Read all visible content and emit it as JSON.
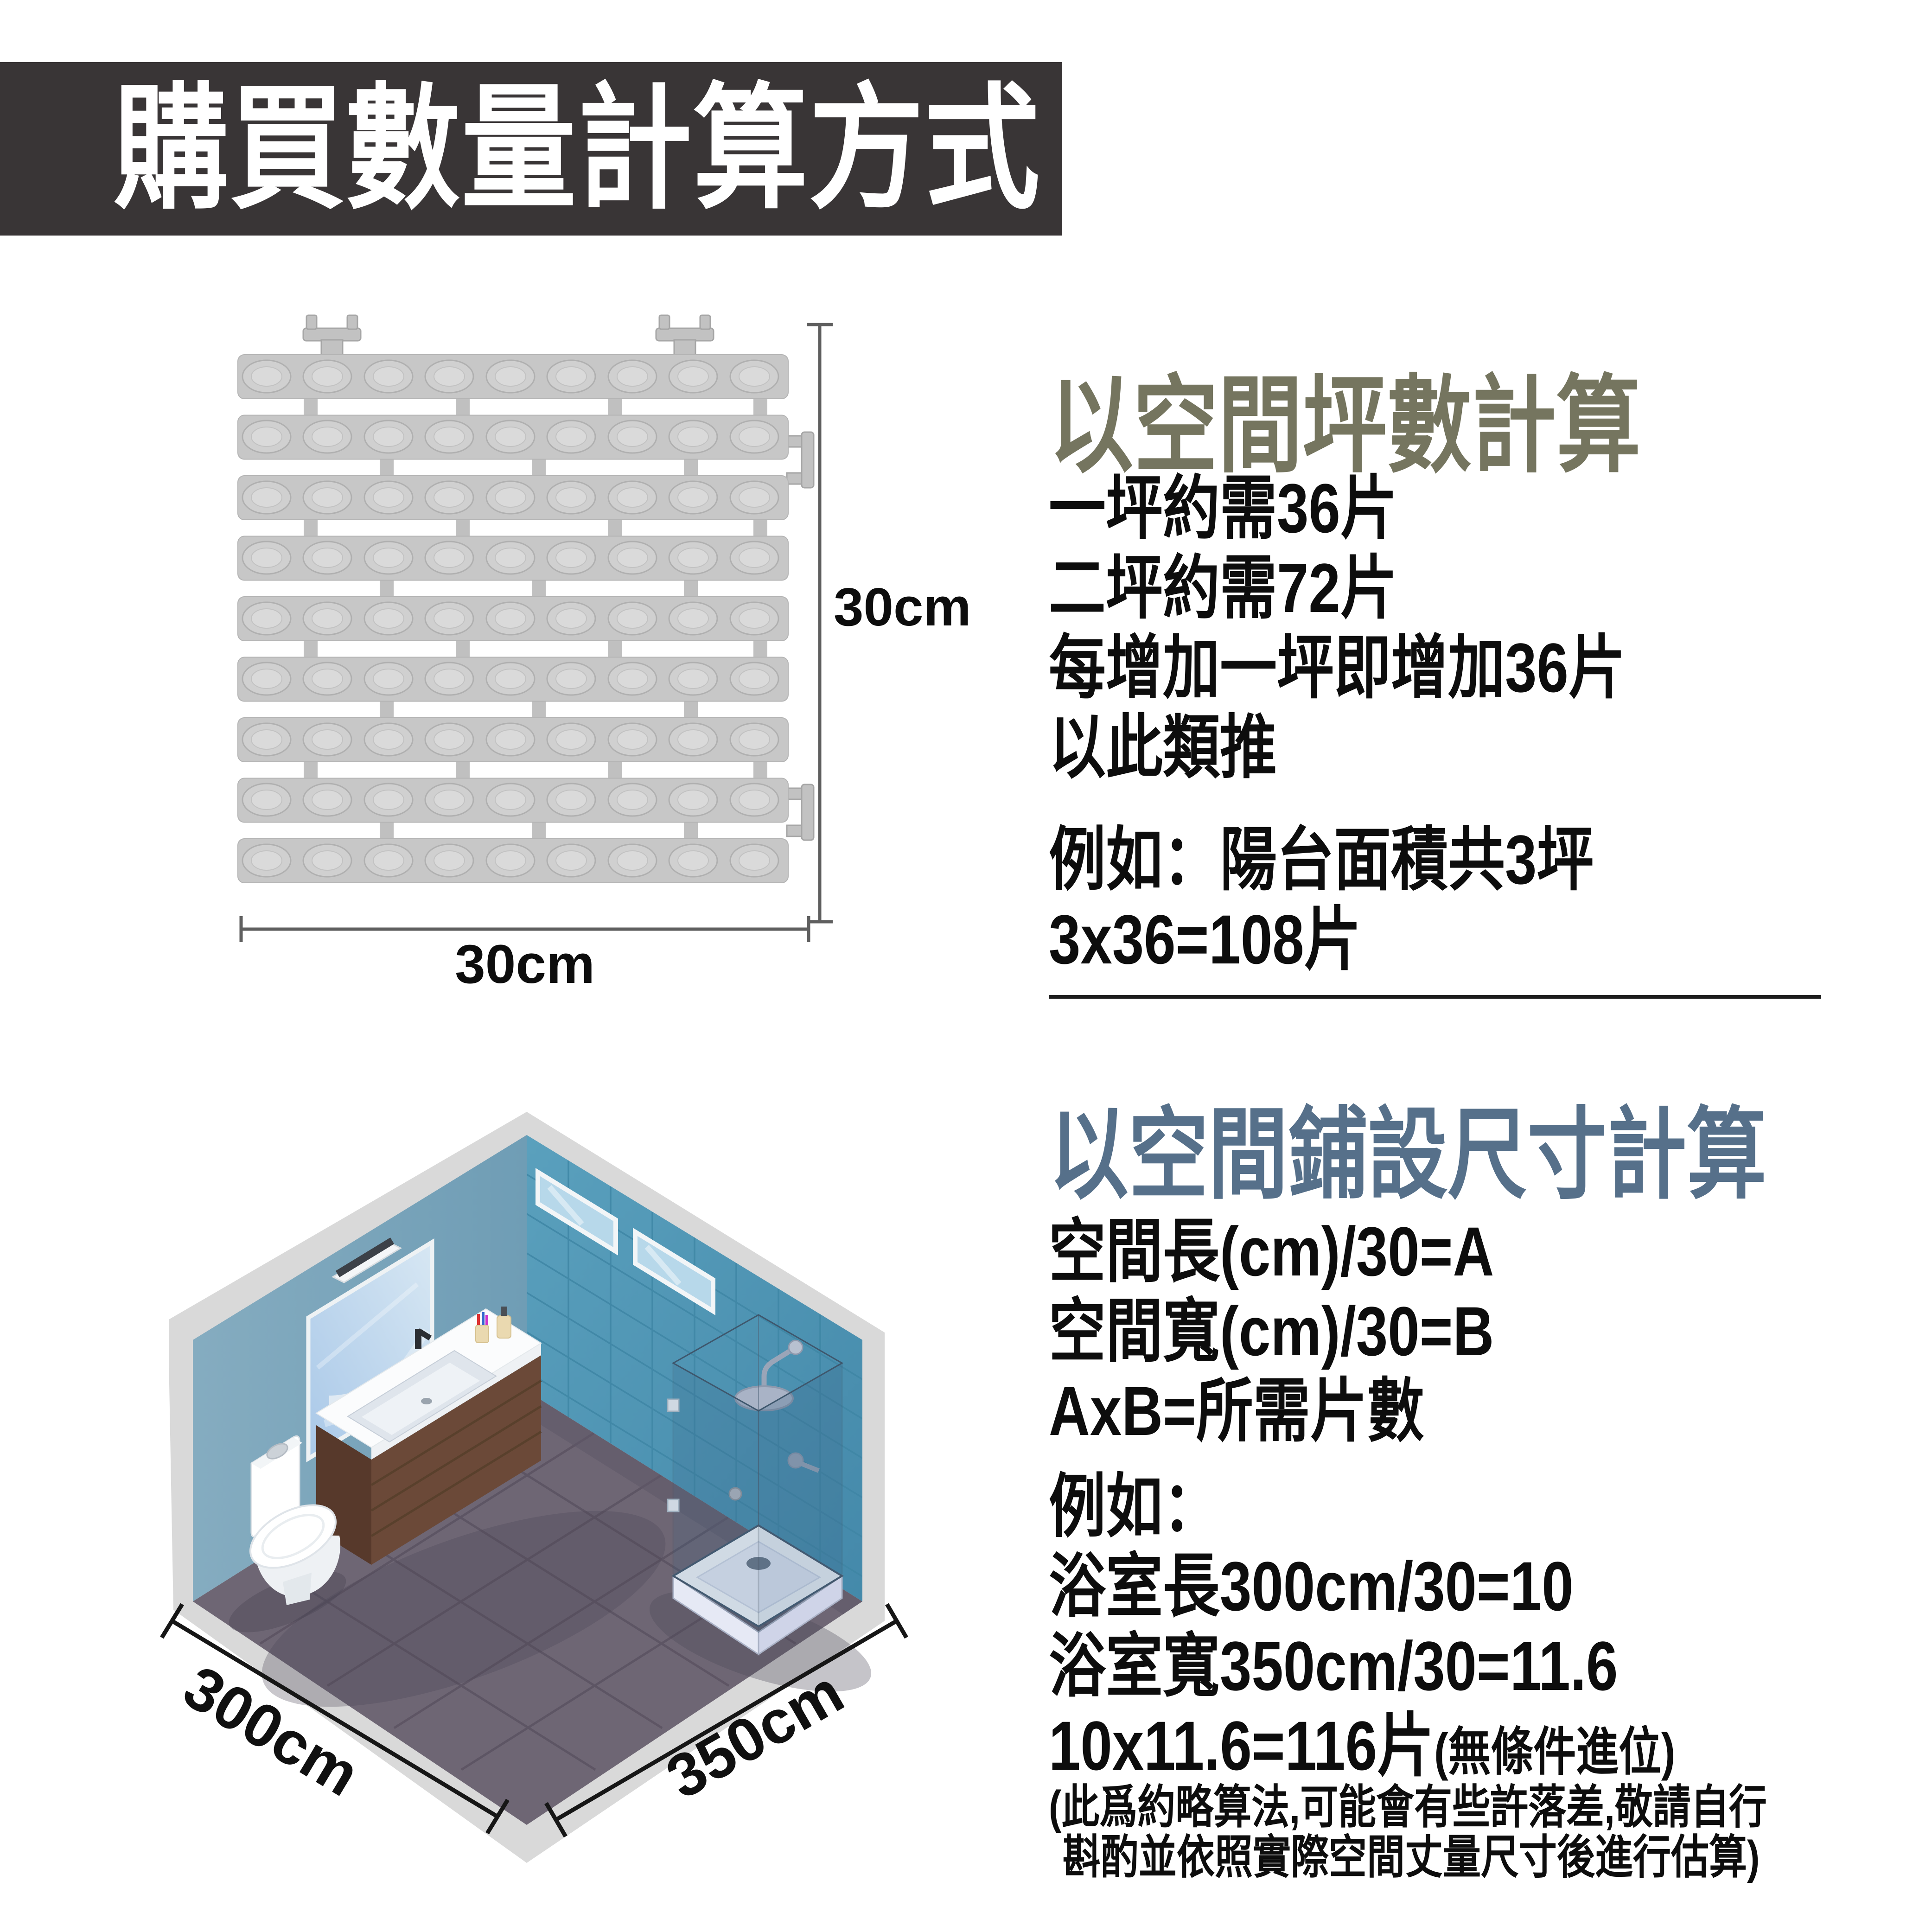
{
  "banner": {
    "title": "購買數量計算方式",
    "bg_color": "#393536",
    "text_color": "#ffffff"
  },
  "tile_figure": {
    "height_label": "30cm",
    "width_label": "30cm",
    "tile_color": "#c7c7c7",
    "bump_color": "#d0d0d0",
    "dimension_line_color": "#5f5f5f"
  },
  "sections": {
    "ping": {
      "heading": "以空間坪數計算",
      "heading_color": "#75755F",
      "lines": [
        "一坪約需36片",
        "二坪約需72片",
        "每增加一坪即增加36片",
        "以此類推"
      ],
      "example_lines": [
        "例如：陽台面積共3坪",
        "3x36=108片"
      ]
    },
    "size": {
      "heading": "以空間鋪設尺寸計算",
      "heading_color": "#56708A",
      "lines": [
        "空間長(cm)/30=A",
        "空間寬(cm)/30=B",
        "AxB=所需片數"
      ],
      "example_label": "例如：",
      "example_lines": [
        "浴室長300cm/30=10",
        "浴室寬350cm/30=11.6"
      ],
      "result_main": "10x11.6=116片",
      "result_note": "(無條件進位)",
      "disclaimer_lines": [
        "(此爲約略算法,可能會有些許落差,敬請自行",
        "斟酌並依照實際空間丈量尺寸後進行估算)"
      ]
    }
  },
  "bathroom": {
    "length_label": "300cm",
    "width_label": "350cm",
    "left_wall_color": "#7aa3b9",
    "right_wall_color": "#4d94b4",
    "floor_color": "#6e6674",
    "frame_color": "#d9d9d9"
  }
}
